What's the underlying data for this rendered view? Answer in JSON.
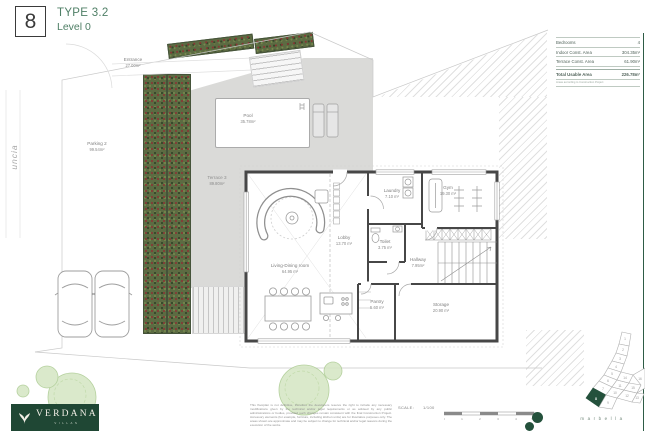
{
  "header": {
    "number": "8",
    "type": "TYPE 3.2",
    "level": "Level 0"
  },
  "summary_table": {
    "rows": [
      {
        "label": "Bedrooms",
        "value": "4"
      },
      {
        "label": "Indoor Const. Area",
        "value": "304.35m²"
      },
      {
        "label": "Terrace Const. Area",
        "value": "61.90m²"
      },
      {
        "label": "Total Usable Area",
        "value": "226.78m²"
      }
    ],
    "note": "Areas according to Construction Project"
  },
  "plan_labels": {
    "street": "uncia",
    "entrance": {
      "name": "Entrance",
      "area": "27.00m²"
    },
    "parking": {
      "name": "Parking 2",
      "area": "99.54m²"
    },
    "terrace": {
      "name": "Terrace 3",
      "area": "89.80m²"
    },
    "pool": {
      "name": "Pool",
      "area": "35.78m²"
    }
  },
  "rooms": [
    {
      "name": "Living-Dining room",
      "area": "64.95 m²"
    },
    {
      "name": "Lobby",
      "area": "13.70 m²"
    },
    {
      "name": "Laundry",
      "area": "7.10 m²"
    },
    {
      "name": "Gym",
      "area": "19.30 m²"
    },
    {
      "name": "Toilet",
      "area": "3.75 m²"
    },
    {
      "name": "Hallway",
      "area": "7.95m²"
    },
    {
      "name": "Pantry",
      "area": "5.60 m²"
    },
    {
      "name": "Storage",
      "area": "20.90 m²"
    }
  ],
  "footer": {
    "disclaimer": "This floorplan is not definitive, therefore the developers reserve the right to include any necessary modifications given by the technical and/or legal requirements or as advised by any public administrations or bodies, provided such changes remain consistent with the final Construction Project. Accessory elements (for example, furniture, including kitchen units) are for illustrative purposes only. The areas shown are approximate and may be subject to change for technical and/or legal reasons during the execution of the works.",
    "scale_label": "SCALE:",
    "scale_value": "1/100",
    "scale_ticks": [
      "0",
      "1",
      "2",
      "3",
      "4",
      "5 m"
    ]
  },
  "branding": {
    "name": "VERDANA",
    "tagline": "VILLAS",
    "city": "marbella"
  },
  "keyplan": {
    "lots": [
      "1",
      "2",
      "3",
      "4",
      "5",
      "6",
      "7",
      "8",
      "9",
      "10",
      "11",
      "12",
      "13",
      "14",
      "15",
      "16"
    ],
    "highlighted": "8"
  },
  "colors": {
    "accent_green": "#2e5c46",
    "logo_green": "#1f4734",
    "hedge_green": "#5c6b42",
    "terrace_grey": "#dadad8",
    "wall_grey": "#474747"
  }
}
